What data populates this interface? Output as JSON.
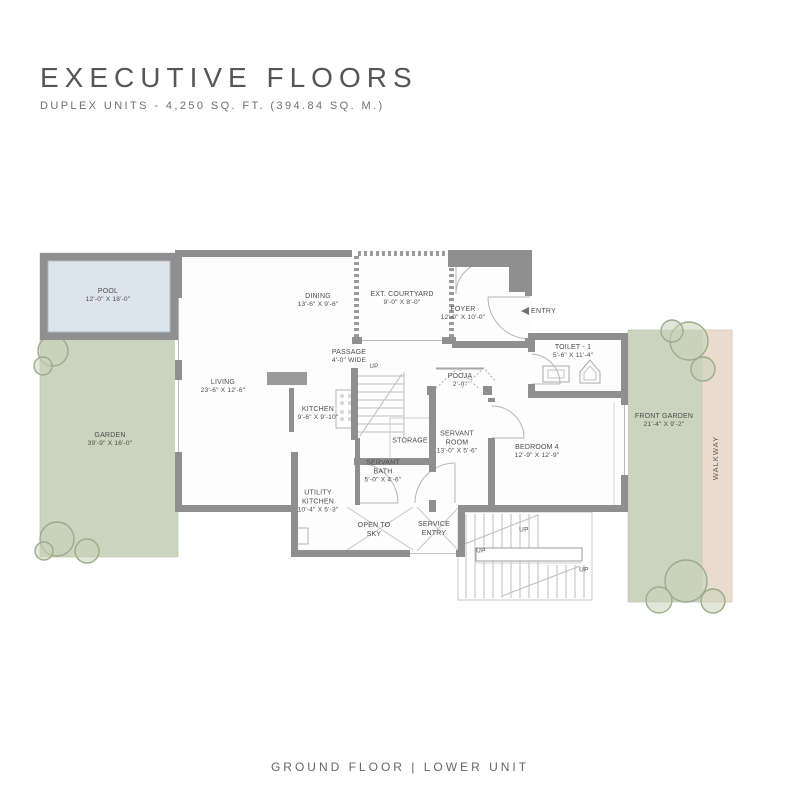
{
  "header": {
    "title": "EXECUTIVE FLOORS",
    "subtitle": "DUPLEX UNITS - 4,250 SQ. FT. (394.84 SQ. M.)"
  },
  "footer": {
    "caption": "GROUND FLOOR | LOWER UNIT"
  },
  "rooms": {
    "pool": {
      "name": "POOL",
      "dims": "12'-0\" X 18'-0\""
    },
    "garden": {
      "name": "GARDEN",
      "dims": "39'-9\" X 16'-0\""
    },
    "dining": {
      "name": "DINING",
      "dims": "13'-6\" X 9'-6\""
    },
    "ext_courtyard": {
      "name": "EXT. COURTYARD",
      "dims": "9'-0\" X 8'-0\""
    },
    "foyer": {
      "name": "FOYER",
      "dims": "12'-0\" X 10'-0\""
    },
    "toilet1": {
      "name": "TOILET - 1",
      "dims": "5'-6\" X 11'-4\""
    },
    "living": {
      "name": "LIVING",
      "dims": "23'-6\" X 12'-6\""
    },
    "passage": {
      "name": "PASSAGE",
      "dims": "4'-0\" WIDE"
    },
    "kitchen": {
      "name": "KITCHEN",
      "dims": "9'-6\" X 9'-10\""
    },
    "pooja": {
      "name": "POOJA",
      "dims": "2'-0\""
    },
    "storage": {
      "name": "STORAGE",
      "dims": ""
    },
    "servant_room": {
      "name": "SERVANT ROOM",
      "dims": "13'-0\" X 5'-6\""
    },
    "bedroom4": {
      "name": "BEDROOM 4",
      "dims": "12'-9\" X 12'-9\""
    },
    "servant_bath": {
      "name": "SERVANT BATH",
      "dims": "5'-0\" X 4'-6\""
    },
    "utility_kitchen": {
      "name": "UTILITY KITCHEN",
      "dims": "10'-4\" X 5'-3\""
    },
    "open_to_sky": {
      "name": "OPEN TO SKY",
      "dims": ""
    },
    "service_entry": {
      "name": "SERVICE ENTRY",
      "dims": ""
    },
    "front_garden": {
      "name": "FRONT GARDEN",
      "dims": "21'-4\" X 9'-2\""
    },
    "walkway": {
      "name": "WALKWAY",
      "dims": ""
    }
  },
  "annotations": {
    "entry": "ENTRY",
    "up": "UP"
  },
  "colors": {
    "wall": "#8f8f8f",
    "garden": "#cbd4be",
    "pool_water": "#dde5ec",
    "walkway": "#e9dbce",
    "text": "#4c4c4c"
  }
}
